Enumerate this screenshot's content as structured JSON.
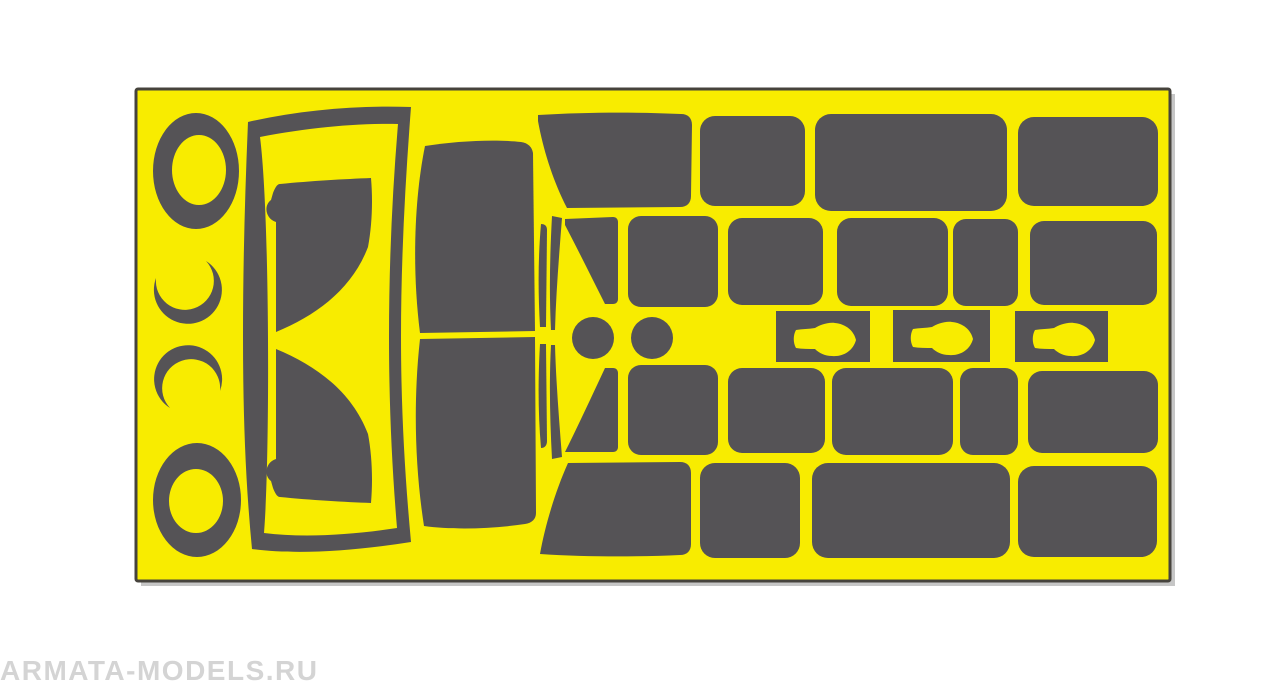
{
  "canvas": {
    "background": "#ffffff"
  },
  "watermark": {
    "text": "ARMATA-MODELS.RU",
    "color": "#d4d4d4"
  },
  "sheet": {
    "x": 136,
    "y": 89,
    "width": 1034,
    "height": 492,
    "fill": "#f8ec00",
    "stroke": "#46433c",
    "stroke_width": 3,
    "shadow_color": "#c6c6c6"
  },
  "mask_color": "#555356",
  "shapes": [
    {
      "name": "mask-ring-top",
      "type": "donut",
      "cx": 196,
      "cy": 171,
      "rx": 43,
      "ry": 58,
      "icx": 199,
      "icy": 170,
      "irx": 27,
      "iry": 35
    },
    {
      "name": "mask-crescent-upper",
      "type": "path",
      "d": "M156,278 A34,34 0 1 0 206,261 A29,29 0 1 1 156,278 Z"
    },
    {
      "name": "mask-crescent-lower",
      "type": "path",
      "d": "M170,408 A34,34 0 1 1 220,391 A29,29 0 1 0 170,408 Z"
    },
    {
      "name": "mask-ring-bottom",
      "type": "donut",
      "cx": 197,
      "cy": 500,
      "rx": 44,
      "ry": 57,
      "icx": 196,
      "icy": 501,
      "irx": 27,
      "iry": 32
    },
    {
      "name": "mask-windshield-frame",
      "type": "path",
      "fillRule": "evenodd",
      "d": "M248,122 C300,110 358,105 411,107 C405,185 401,262 401,337 C401,410 405,477 411,542 C354,551 297,555 252,549 C245,477 243,407 243,336 C243,264 245,192 248,122 Z M260,137 C306,128 356,123 398,124 C392,196 389,267 389,337 C389,405 392,467 397,528 C351,535 304,538 264,533 C270,460 270,215 260,137 Z"
    },
    {
      "name": "mask-windshield-upper",
      "type": "path",
      "d": "M280,184 C310,181 345,179 371,178 C373,201 372,226 368,247 C352,289 317,315 276,332 L276,222 C266,219 263,206 271,200 L273,193 C275,188 277,184 280,184 Z"
    },
    {
      "name": "mask-windshield-lower",
      "type": "path",
      "d": "M280,497 C310,500 345,502 371,503 C373,480 372,455 368,434 C352,392 317,366 276,349 L276,459 C266,462 263,475 271,481 L273,488 C275,493 277,497 280,497 Z"
    },
    {
      "name": "mask-roof-upper",
      "type": "path",
      "d": "M425,146 C456,141 495,139 521,142 C528,143 532,147 533,153 L535,331 L420,333 C412,270 414,200 425,146 Z"
    },
    {
      "name": "mask-roof-lower",
      "type": "path",
      "d": "M420,339 L535,337 L536,513 C536,519 532,523 525,524 C492,529 453,530 424,526 C415,468 413,402 420,339 Z"
    },
    {
      "name": "mask-pillar-strip-upper-inner",
      "type": "path",
      "d": "M541,224 C545,224 547,226 547,230 L546,327 L540,327 C538,292 538,258 541,224 Z"
    },
    {
      "name": "mask-pillar-strip-lower-inner",
      "type": "path",
      "d": "M540,344 L546,344 L547,441 C547,445 545,448 541,448 C538,414 538,378 540,344 Z"
    },
    {
      "name": "mask-pillar-strip-upper-outer",
      "type": "path",
      "d": "M552,216 L562,218 C559,256 556,294 555,330 L551,330 C549,292 550,253 552,216 Z"
    },
    {
      "name": "mask-pillar-strip-lower-outer",
      "type": "path",
      "d": "M551,345 L555,345 C556,381 559,419 562,457 L552,459 C550,421 549,382 551,345 Z"
    },
    {
      "name": "mask-quarter-window-top",
      "type": "path",
      "d": "M538,115 C586,112 639,112 681,114 C688,114 692,118 692,125 L691,196 C691,203 687,207 680,207 L567,208 C553,181 543,149 538,121 Z"
    },
    {
      "name": "mask-quarter-window-bottom",
      "type": "path",
      "d": "M568,463 L680,462 C687,462 691,466 691,473 L691,544 C691,551 687,555 680,555 C637,557 586,557 540,554 C545,526 555,492 568,463 Z"
    },
    {
      "name": "mask-vent-window-upper",
      "type": "path",
      "d": "M565,219 L613,217 C616,217 618,219 618,222 L618,299 C618,302 616,304 613,304 L605,304 C591,276 577,248 565,225 Z"
    },
    {
      "name": "mask-vent-window-lower",
      "type": "path",
      "d": "M605,368 L613,368 C616,368 618,370 618,373 L618,447 C618,450 616,452 613,452 L565,452 C577,428 591,398 605,368 Z"
    },
    {
      "name": "mask-headlight-left",
      "type": "circle",
      "cx": 593,
      "cy": 338,
      "r": 21
    },
    {
      "name": "mask-headlight-right",
      "type": "circle",
      "cx": 652,
      "cy": 338,
      "r": 21
    },
    {
      "name": "mask-window-r1c1",
      "type": "rrect",
      "x": 700,
      "y": 116,
      "w": 105,
      "h": 90,
      "r": 15
    },
    {
      "name": "mask-window-r1c2",
      "type": "rrect",
      "x": 815,
      "y": 114,
      "w": 192,
      "h": 97,
      "r": 16
    },
    {
      "name": "mask-window-r1c3",
      "type": "rrect",
      "x": 1018,
      "y": 117,
      "w": 140,
      "h": 89,
      "r": 16
    },
    {
      "name": "mask-window-r2c1",
      "type": "rrect",
      "x": 628,
      "y": 216,
      "w": 90,
      "h": 91,
      "r": 13
    },
    {
      "name": "mask-window-r2c2",
      "type": "rrect",
      "x": 728,
      "y": 218,
      "w": 95,
      "h": 87,
      "r": 14
    },
    {
      "name": "mask-window-r2c3",
      "type": "rrect",
      "x": 837,
      "y": 218,
      "w": 111,
      "h": 88,
      "r": 14
    },
    {
      "name": "mask-window-r2c4",
      "type": "rrect",
      "x": 953,
      "y": 219,
      "w": 65,
      "h": 87,
      "r": 13
    },
    {
      "name": "mask-window-r2c5",
      "type": "rrect",
      "x": 1030,
      "y": 221,
      "w": 127,
      "h": 84,
      "r": 14
    },
    {
      "name": "mask-mirror-1",
      "type": "keyhole",
      "x": 776,
      "y": 311,
      "w": 94,
      "h": 51
    },
    {
      "name": "mask-mirror-2",
      "type": "keyhole",
      "x": 893,
      "y": 310,
      "w": 97,
      "h": 52
    },
    {
      "name": "mask-mirror-3",
      "type": "keyhole",
      "x": 1015,
      "y": 311,
      "w": 93,
      "h": 51
    },
    {
      "name": "mask-window-r4c1",
      "type": "rrect",
      "x": 628,
      "y": 365,
      "w": 90,
      "h": 90,
      "r": 13
    },
    {
      "name": "mask-window-r4c2",
      "type": "rrect",
      "x": 728,
      "y": 368,
      "w": 97,
      "h": 85,
      "r": 14
    },
    {
      "name": "mask-window-r4c3",
      "type": "rrect",
      "x": 832,
      "y": 368,
      "w": 121,
      "h": 87,
      "r": 14
    },
    {
      "name": "mask-window-r4c4",
      "type": "rrect",
      "x": 960,
      "y": 368,
      "w": 58,
      "h": 87,
      "r": 13
    },
    {
      "name": "mask-window-r4c5",
      "type": "rrect",
      "x": 1028,
      "y": 371,
      "w": 130,
      "h": 82,
      "r": 14
    },
    {
      "name": "mask-window-r5c1",
      "type": "rrect",
      "x": 700,
      "y": 463,
      "w": 100,
      "h": 95,
      "r": 15
    },
    {
      "name": "mask-window-r5c2",
      "type": "rrect",
      "x": 812,
      "y": 463,
      "w": 198,
      "h": 95,
      "r": 16
    },
    {
      "name": "mask-window-r5c3",
      "type": "rrect",
      "x": 1018,
      "y": 466,
      "w": 139,
      "h": 91,
      "r": 16
    }
  ]
}
